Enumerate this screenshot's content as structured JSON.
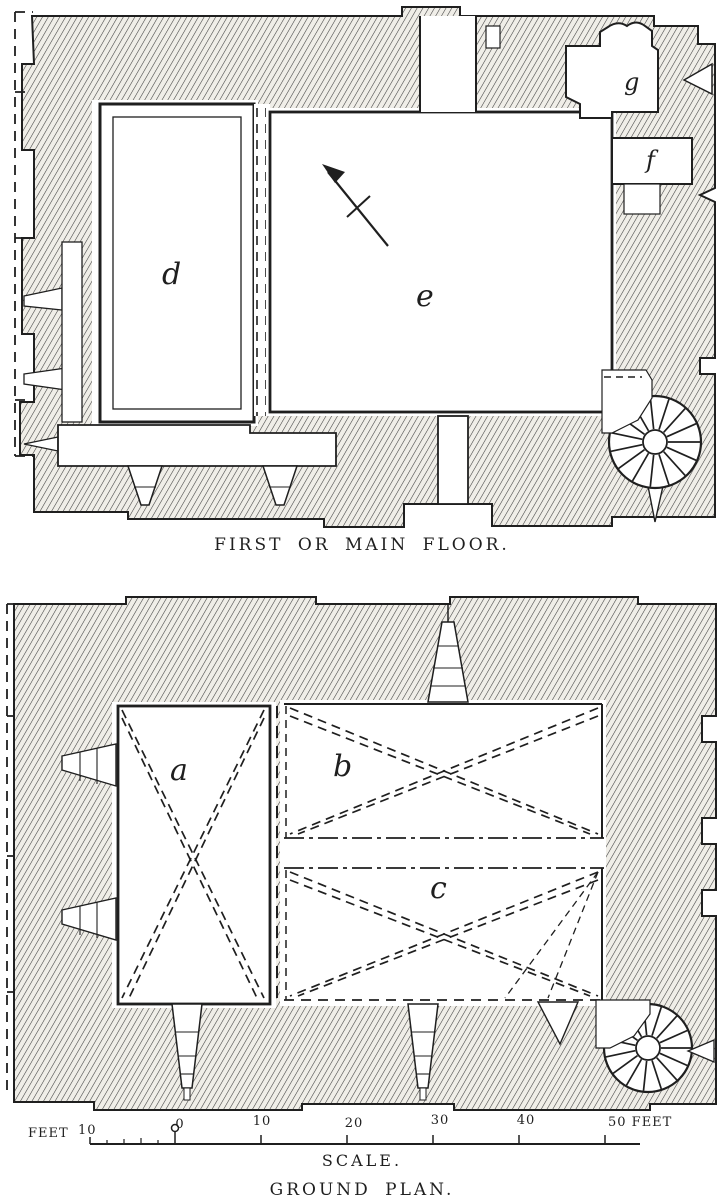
{
  "first_floor_plan": {
    "caption": "FIRST OR MAIN FLOOR.",
    "room_labels": {
      "d": "d",
      "e": "e",
      "f": "f",
      "g": "g"
    }
  },
  "ground_plan": {
    "caption": "GROUND PLAN.",
    "room_labels": {
      "a": "a",
      "b": "b",
      "c": "c"
    }
  },
  "scale_bar": {
    "caption": "SCALE.",
    "unit_left": "FEET",
    "left_tick_label": "10",
    "tick_labels": [
      "0",
      "10",
      "20",
      "30",
      "40"
    ],
    "right_label": "50 FEET"
  },
  "colors": {
    "ink": "#1f1f1f",
    "paper": "#ffffff",
    "hatch_fill": "#f0eee8"
  }
}
